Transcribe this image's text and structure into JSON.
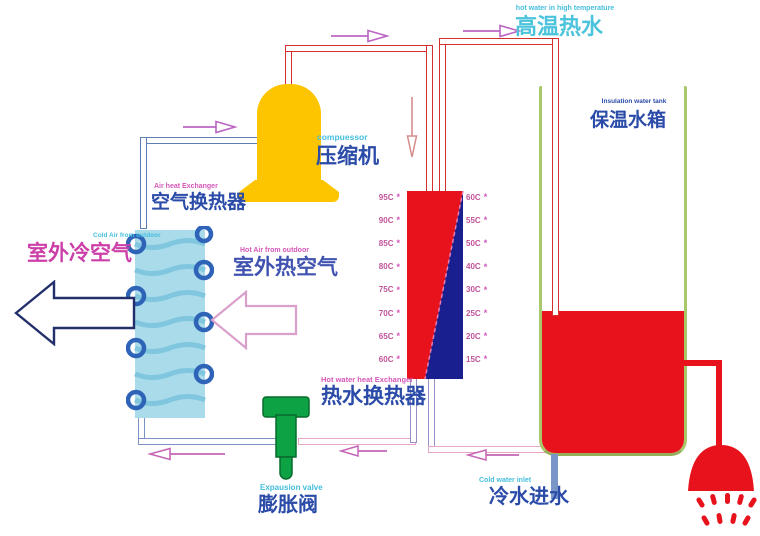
{
  "diagram": {
    "title_flow_top": {
      "en_small": "hot water in high temperature",
      "zh": "高温热水"
    },
    "compressor": {
      "en": "compuessor",
      "zh": "压缩机"
    },
    "air_heat_exchanger": {
      "en": "Air heat Exchanger",
      "zh": "空气换热器"
    },
    "cold_air": {
      "en_small": "Cold Air from outdoor",
      "zh": "室外冷空气"
    },
    "hot_air": {
      "en_small": "Hot Air from outdoor",
      "zh": "室外热空气"
    },
    "hot_water_heat_exchanger": {
      "en": "Hot water heat Exchanger",
      "zh": "热水换热器"
    },
    "expansion_valve": {
      "en": "Expausion valve",
      "zh": "膨胀阀"
    },
    "cold_water_inlet": {
      "en": "Cold water inlet",
      "zh": "冷水进水"
    },
    "tank": {
      "en": "Insulation water tank",
      "zh": "保温水箱"
    },
    "hx_scale": {
      "left": [
        "95C",
        "90C",
        "85C",
        "80C",
        "75C",
        "70C",
        "65C",
        "60C"
      ],
      "right": [
        "60C",
        "55C",
        "50C",
        "40C",
        "30C",
        "25C",
        "20C",
        "15C"
      ],
      "marker": "*"
    },
    "colors": {
      "hot_red": "#e8121c",
      "cold_navy": "#1a1f8f",
      "compressor_yellow": "#fdc500",
      "valve_green": "#0da344",
      "tank_border_green": "#a8c86a",
      "coil_light_blue": "#aadbea",
      "coil_loop_blue": "#2f63b8",
      "pipe_red": "#d43030",
      "pipe_blue": "#5b7fb5",
      "pipe_pink": "#e8a6c6",
      "pipe_violet": "#8898cc",
      "text_cyan": "#45bedd",
      "text_blue": "#2b4ba8",
      "text_magenta": "#cc3fa8",
      "temp_text": "#c2549a"
    }
  }
}
